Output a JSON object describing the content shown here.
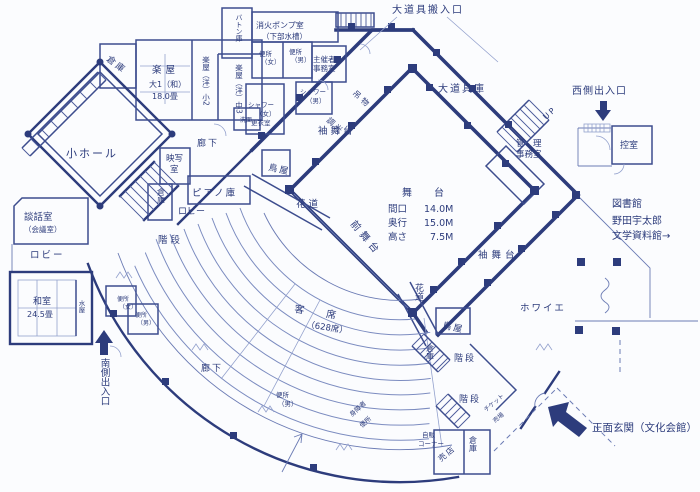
{
  "colors": {
    "ink": "#2d3c7c",
    "wall": "#3d4d8e",
    "thin": "#6b7bb4",
    "seat_line": "#7c8cc0",
    "paper": "#fbfcfe"
  },
  "annotations": {
    "prop_load_entrance": "大道具搬入口",
    "west_exit": "西側出入口",
    "main_entrance": "正面玄関（文化会館）",
    "south_exit": "南側出入口",
    "library_line1": "図書館",
    "library_line2": "野田宇太郎",
    "library_line3": "文学資料館→",
    "up": "UP"
  },
  "stage": {
    "stage_title": "舞　台",
    "spec_rows": [
      {
        "k": "間口",
        "v": "14.0M"
      },
      {
        "k": "奥行",
        "v": "15.0M"
      },
      {
        "k": "高さ",
        "v": "7.5M"
      }
    ],
    "fore_stage": "前舞台",
    "side_stage": "袖舞台",
    "hanamichi": "花道",
    "toya": "鳥屋",
    "flybar": "吊物",
    "dimmer": "調光",
    "prop_storage": "大道具庫",
    "audience": "客　席",
    "audience_capacity": "（628席）"
  },
  "rooms": {
    "storage": "倉庫",
    "dressing": "楽屋",
    "dressing_large_type": "大1（和）",
    "dressing_large_size": "18.0畳",
    "dressing_small": "楽屋（洋）小2",
    "dressing_mid": "楽屋（洋）中3",
    "washstand": "洗面",
    "batten_storage": "バトン庫",
    "fire_pump": "消火ポンプ室",
    "fire_pump_sub": "（下部水槽）",
    "toilet": "便所",
    "female": "（女）",
    "male": "（男）",
    "organizer_line1": "主催者",
    "organizer_line2": "事務室",
    "shower": "シャワー",
    "changing_room": "更衣室",
    "small_hall": "小ホール",
    "projection_line1": "映写",
    "projection_line2": "室",
    "corridor": "廊下",
    "piano_storage": "ピアノ庫",
    "lobby": "ロビー",
    "stairs": "階段",
    "parlor": "談話室",
    "parlor_sub": "（会議室）",
    "japanese_room": "和室",
    "japanese_room_size": "24.5畳",
    "mizuya": "水屋",
    "admin_line1": "管　理",
    "admin_line2": "事務室",
    "waiting_room": "控室",
    "foyer": "ホワイエ",
    "accessible_line1": "身障者",
    "accessible_line2": "便所",
    "ticket_line1": "チケット",
    "ticket_line2": "売場",
    "vending_line1": "自販",
    "vending_line2": "コーナー",
    "shop": "売店"
  }
}
